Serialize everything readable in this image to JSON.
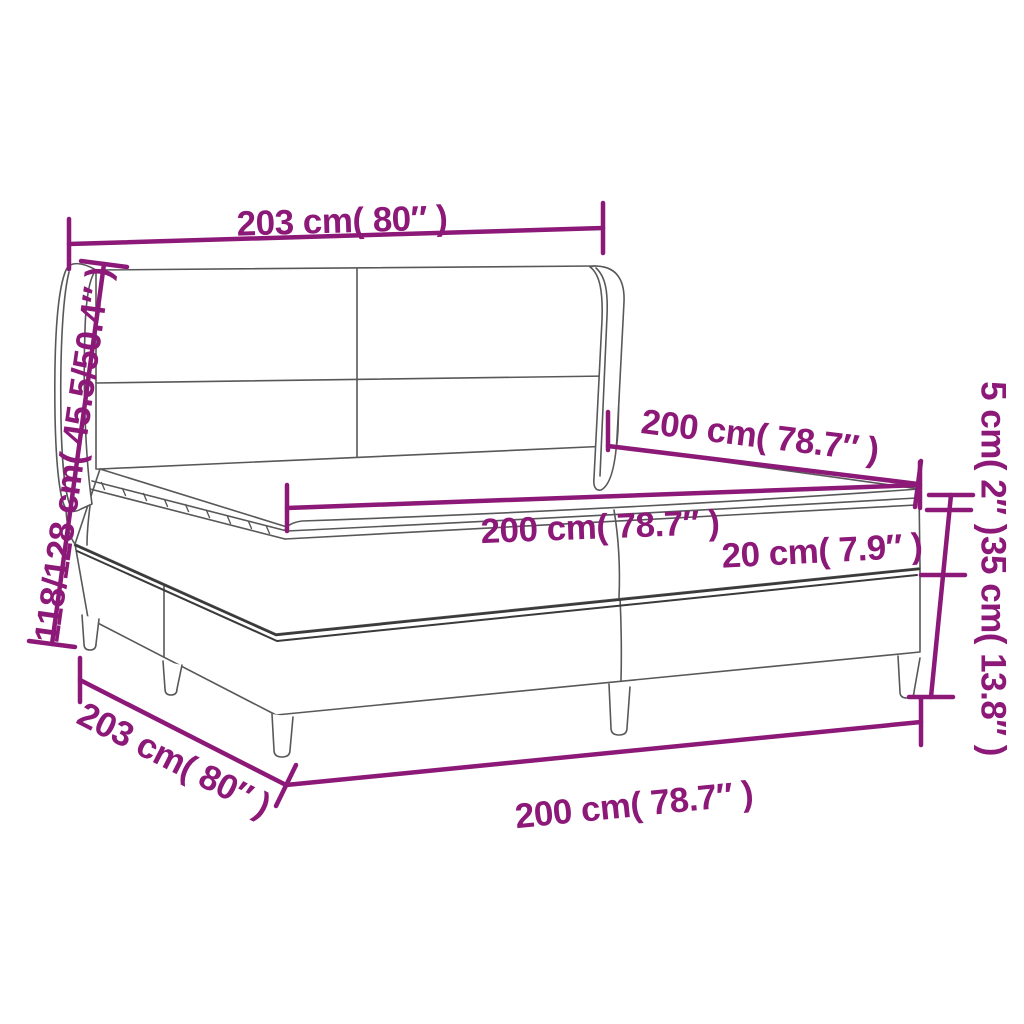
{
  "page": {
    "background": "#ffffff"
  },
  "diagram": {
    "subject": "box-spring-bed-with-winged-headboard-dimension-diagram",
    "accent_color": "#8C1878",
    "outline_color": "#58585a",
    "labels": {
      "headboard_width": "203 cm( 80″ )",
      "total_height": "118/128 cm( 45.5/50.4″ )",
      "top_depth": "200 cm( 78.7″ )",
      "mattress_width": "200 cm( 78.7″ )",
      "mattress_thickness": "20 cm( 7.9″ )",
      "topper_thickness": "5 cm( 2″ )",
      "base_height": "35 cm( 13.8″ )",
      "base_depth": "203 cm( 80″ )",
      "base_width": "200 cm( 78.7″ )"
    }
  }
}
